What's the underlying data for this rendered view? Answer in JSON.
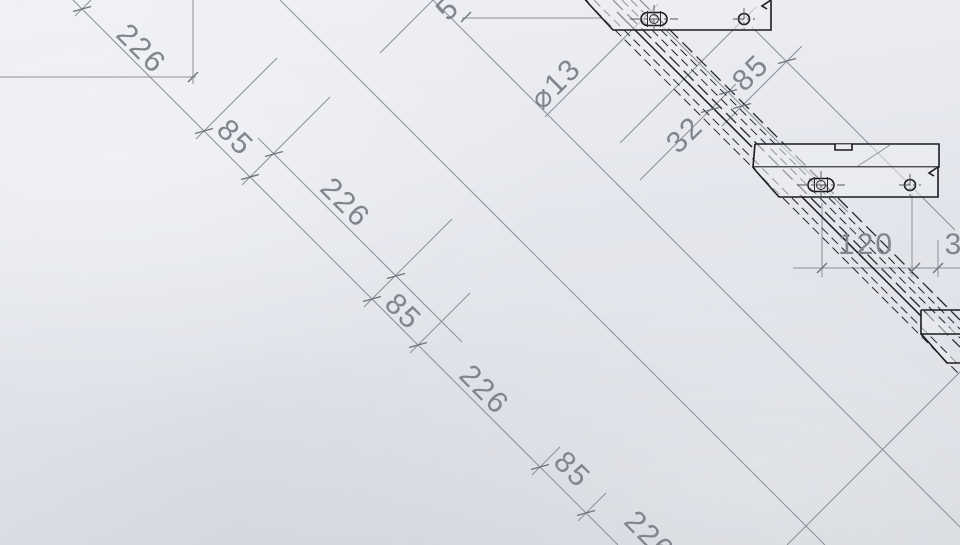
{
  "app": {
    "view_title": "stair-stringer-drawing-view"
  },
  "drawing": {
    "colors": {
      "construction": "#8d8f96",
      "edges": "#1b1c21",
      "dim_text": "#83858c"
    },
    "labels": [
      {
        "t": "226",
        "x": 140,
        "y": 50,
        "r": 45
      },
      {
        "t": "85",
        "x": 234,
        "y": 139,
        "r": 45
      },
      {
        "t": "226",
        "x": 344,
        "y": 204,
        "r": 45
      },
      {
        "t": "85",
        "x": 402,
        "y": 313,
        "r": 45
      },
      {
        "t": "226",
        "x": 483,
        "y": 391,
        "r": 45
      },
      {
        "t": "85",
        "x": 571,
        "y": 471,
        "r": 45
      },
      {
        "t": "226",
        "x": 648,
        "y": 537,
        "r": 45
      },
      {
        "t": "5",
        "x": 449,
        "y": 10,
        "r": -45
      },
      {
        "t": "⌀13",
        "x": 557,
        "y": 85,
        "r": -45
      },
      {
        "t": "85",
        "x": 752,
        "y": 74,
        "r": -45
      },
      {
        "t": "32",
        "x": 686,
        "y": 136,
        "r": -45
      },
      {
        "t": "120",
        "x": 866,
        "y": 246,
        "r": 0
      },
      {
        "t": "3",
        "x": 954,
        "y": 246,
        "r": 0
      }
    ],
    "lines": [
      [
        73,
        0,
        618,
        545,
        "thin"
      ],
      [
        258,
        138,
        462,
        342,
        "thin"
      ],
      [
        280,
        0,
        825,
        545,
        "thin"
      ],
      [
        433,
        0,
        960,
        527,
        "thin"
      ],
      [
        756,
        7,
        620,
        143,
        "thin"
      ],
      [
        960,
        372,
        787,
        545,
        "thin"
      ],
      [
        380,
        53,
        433,
        0,
        "thin"
      ],
      [
        462,
        18,
        601,
        18,
        "thin"
      ],
      [
        0,
        77,
        196,
        77,
        "thin"
      ],
      [
        193,
        0,
        193,
        84,
        "thin"
      ],
      [
        545,
        117,
        658,
        4,
        "thin"
      ],
      [
        722,
        126,
        802,
        46,
        "thin"
      ],
      [
        640,
        180,
        736,
        84,
        "thin"
      ],
      [
        660,
        24,
        848,
        212,
        "thin"
      ],
      [
        752,
        27,
        955,
        230,
        "thin"
      ],
      [
        822,
        203,
        822,
        277,
        "thin"
      ],
      [
        912,
        193,
        912,
        277,
        "thin"
      ],
      [
        938,
        240,
        938,
        277,
        "thin"
      ],
      [
        793,
        268,
        960,
        268,
        "thin"
      ],
      [
        196,
        139,
        277,
        58,
        "thin"
      ],
      [
        242,
        185,
        330,
        97,
        "thin"
      ],
      [
        364,
        307,
        452,
        219,
        "thin"
      ],
      [
        410,
        353,
        470,
        293,
        "thin"
      ],
      [
        532,
        475,
        560,
        447,
        "thin"
      ],
      [
        578,
        521,
        606,
        493,
        "thin"
      ],
      [
        75,
        16,
        91,
        0,
        "thin"
      ],
      [
        858,
        166,
        890,
        145,
        "darkthin"
      ]
    ],
    "band_dashed": [
      [
        640,
        0,
        960,
        320,
        "dash2"
      ],
      [
        631,
        0,
        960,
        329,
        "dash"
      ],
      [
        622,
        0,
        960,
        338,
        "dash"
      ],
      [
        613,
        0,
        960,
        347,
        "dash2"
      ],
      [
        594,
        0,
        960,
        366,
        "dash"
      ],
      [
        585,
        0,
        960,
        375,
        "dash"
      ]
    ],
    "band_solid": [
      [
        617,
        12,
        752,
        147
      ],
      [
        800,
        195,
        921,
        316
      ]
    ],
    "ticks_flat": [
      [
        82,
        9
      ],
      [
        204,
        131
      ],
      [
        250,
        177
      ],
      [
        372,
        299
      ],
      [
        418,
        345
      ],
      [
        540,
        467
      ],
      [
        586,
        513
      ],
      [
        274,
        154
      ],
      [
        396,
        276
      ],
      [
        742,
        106
      ],
      [
        787,
        61
      ],
      [
        710,
        110
      ],
      [
        728,
        92
      ]
    ],
    "ticks_slash": [
      [
        822,
        268
      ],
      [
        915,
        268
      ],
      [
        938,
        268
      ],
      [
        466,
        17
      ],
      [
        193,
        77
      ]
    ],
    "brackets": [
      {
        "name": "step-bracket-top",
        "paths": [
          "M586,0 L589,4 L613,30 L771,30 L771,0",
          "M771,0 L762,6 L767,9"
        ],
        "slot": [
          654,
          19
        ],
        "hole": [
          744,
          19
        ]
      },
      {
        "name": "step-bracket-middle",
        "paths": [
          "M755,144 L939,144 L939,167 L753,167 L755,144",
          "M835,144 L835,150 L852,150 L852,144",
          "M753,167 L756,171 L779,197 L938,197 L938,167",
          "M938,167 L929,173 L934,176"
        ],
        "slot": [
          821,
          185
        ],
        "hole": [
          910,
          185
        ]
      },
      {
        "name": "step-bracket-bottom-partial",
        "paths": [
          "M921,310 L960,310 M921,310 L921,334 L960,334",
          "M921,334 L924,337 L947,363 L960,363"
        ],
        "slot": null,
        "hole": null
      }
    ],
    "slot_size": {
      "w": 26,
      "h": 13,
      "inner_r": 4.5
    },
    "hole_r": 5.5
  }
}
